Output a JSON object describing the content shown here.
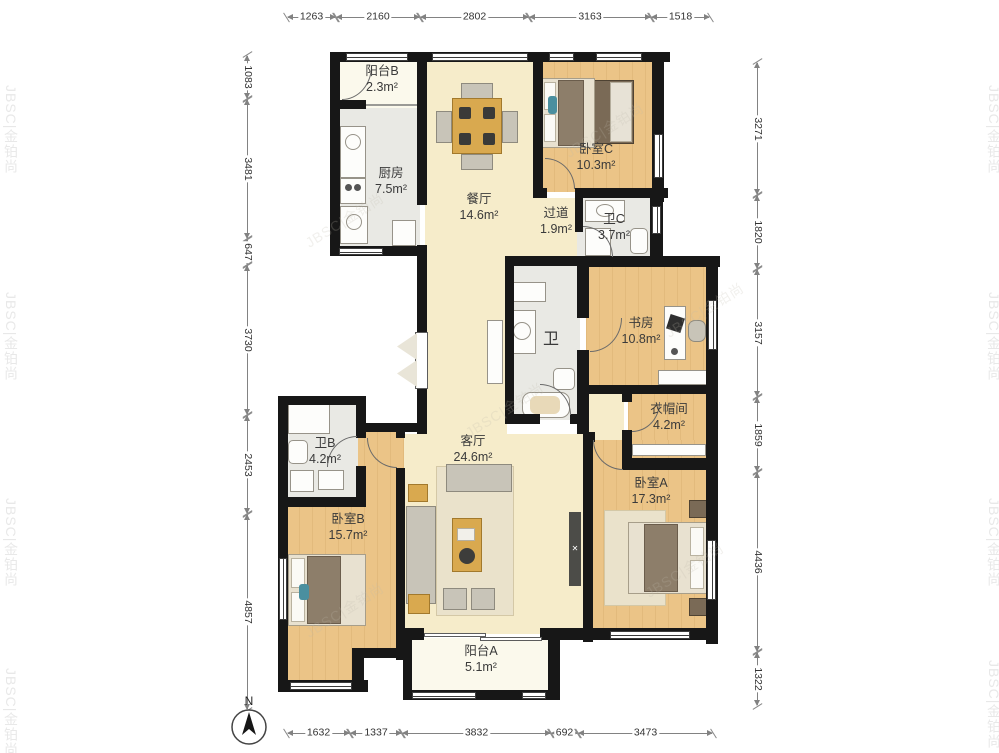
{
  "watermark_text": "JBSC|金铂尚",
  "compass_label": "N",
  "dimensions": {
    "top": [
      "1263",
      "2160",
      "2802",
      "3163",
      "1518"
    ],
    "bottom": [
      "1632",
      "1337",
      "3832",
      "692",
      "3473"
    ],
    "left": [
      "1083",
      "3481",
      "647",
      "3730",
      "2453",
      "4857"
    ],
    "right": [
      "3271",
      "1820",
      "3157",
      "1859",
      "4436",
      "1322"
    ]
  },
  "rooms": {
    "balcony_b": {
      "name": "阳台B",
      "area": "2.3m²"
    },
    "kitchen": {
      "name": "厨房",
      "area": "7.5m²"
    },
    "dining": {
      "name": "餐厅",
      "area": "14.6m²"
    },
    "bedroom_c": {
      "name": "卧室C",
      "area": "10.3m²"
    },
    "hallway": {
      "name": "过道",
      "area": "1.9m²"
    },
    "bath_c": {
      "name": "卫C",
      "area": "3.7m²"
    },
    "study": {
      "name": "书房",
      "area": "10.8m²"
    },
    "cloakroom": {
      "name": "衣帽间",
      "area": "4.2m²"
    },
    "bath_center": {
      "name": "卫"
    },
    "living": {
      "name": "客厅",
      "area": "24.6m²"
    },
    "bath_b": {
      "name": "卫B",
      "area": "4.2m²"
    },
    "bedroom_b": {
      "name": "卧室B",
      "area": "15.7m²"
    },
    "bedroom_a": {
      "name": "卧室A",
      "area": "17.3m²"
    },
    "balcony_a": {
      "name": "阳台A",
      "area": "5.1m²"
    }
  }
}
